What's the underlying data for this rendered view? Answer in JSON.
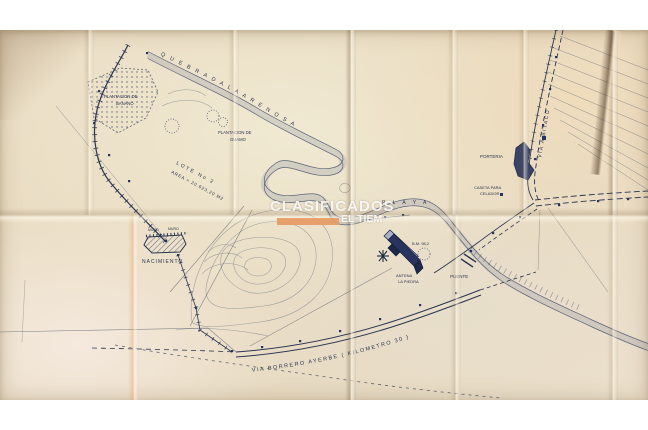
{
  "watermark": {
    "title": "CLASIFICADOS",
    "subtitle": "EL TIEM",
    "bar_color": "#e59a64"
  },
  "map": {
    "labels": {
      "quebrada": "Q U E B R A D A   L A   A R E N O S A",
      "plantacion_banano_1": "PLANTACION DE",
      "plantacion_banano_2": "BANANO",
      "plantacion_guamo_1": "PLANTACION DE",
      "plantacion_guamo_2": "GUAMO",
      "lote_1": "LOTE No 2",
      "lote_2": "AREA = 20.623,20 M2",
      "muro_a": "MURO",
      "muro_b": "MURO",
      "nacimiento": "NACIMIENTO",
      "playa": "P L A Y A",
      "bm": "B.M. 98,2",
      "antena_1": "ANTENA",
      "antena_2": "LA PIEDRA",
      "puente": "PUENTE",
      "porteria": "PORTERIA",
      "caseta_1": "CASETA PARA",
      "caseta_2": "CELADOR",
      "via_bitaco": "VIA A BITACO",
      "via_borrero": "VIA BORRERO AYERBE ( KILOMETRO 30 )"
    },
    "colors": {
      "ink": "#2a3550",
      "paper": "#e9dcc2",
      "river_band": "#8d97a8",
      "building_fill": "#28345f"
    }
  }
}
